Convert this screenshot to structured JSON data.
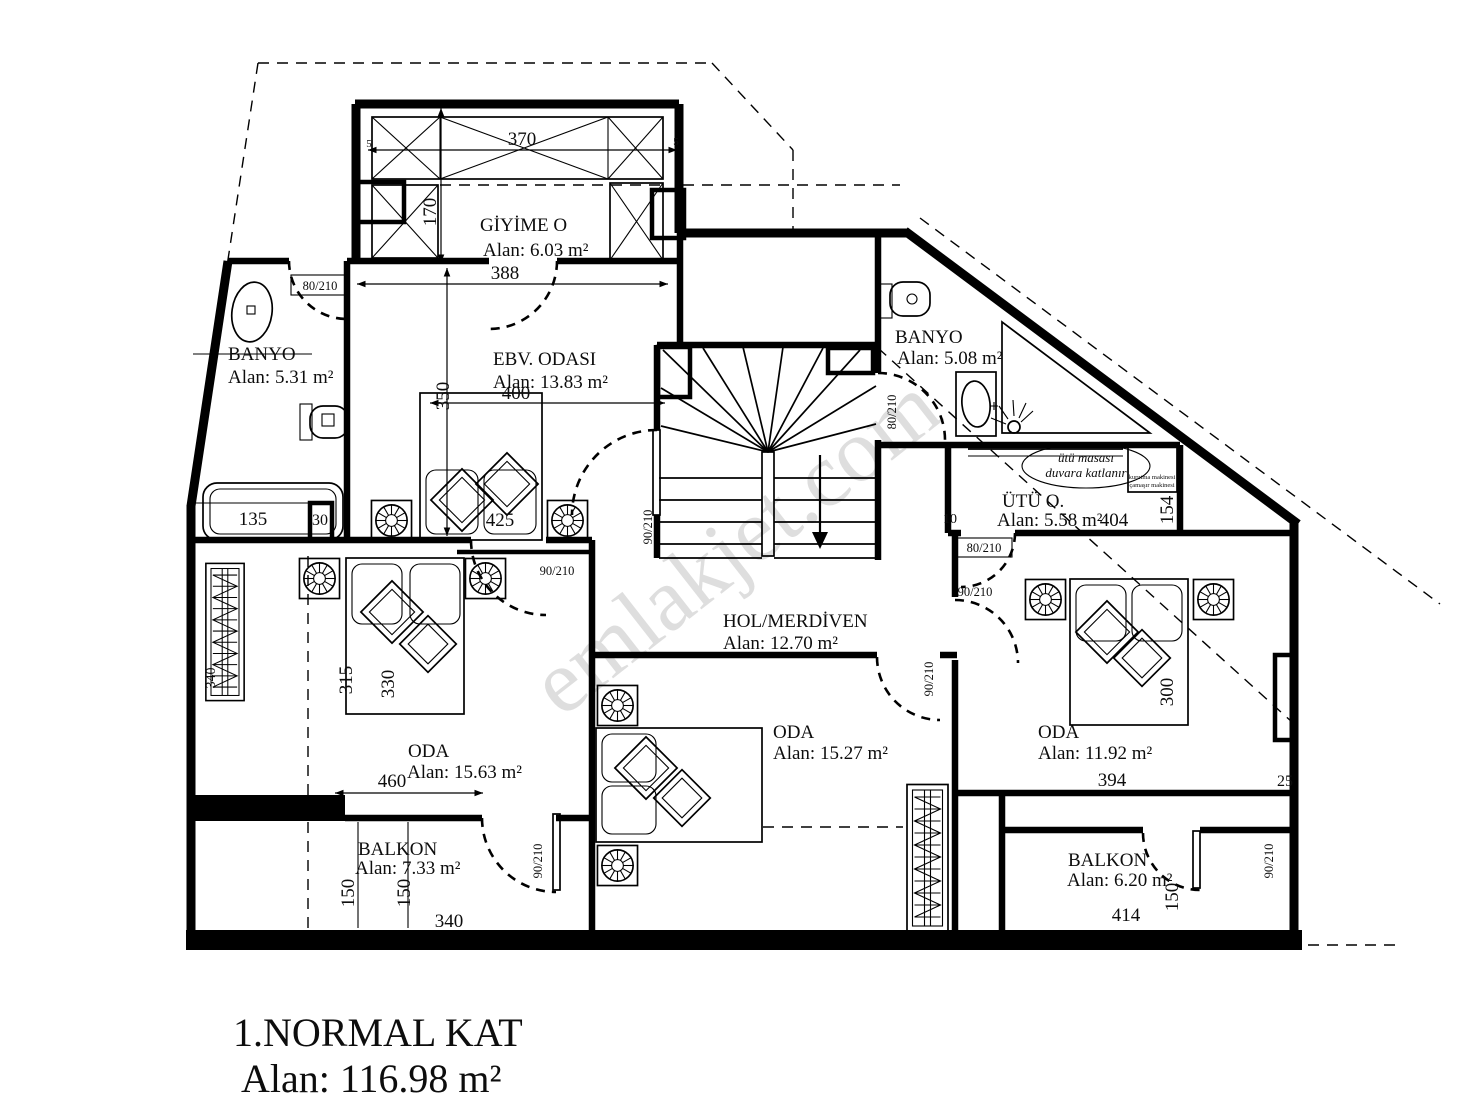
{
  "title": {
    "line1": "1.NORMAL KAT",
    "line2": "Alan: 116.98 m²"
  },
  "watermark": "emlakjet.com",
  "rooms": {
    "giyime": {
      "name": "GİYİME O",
      "area": "Alan: 6.03 m²"
    },
    "banyo_sol": {
      "name": "BANYO",
      "area": "Alan: 5.31 m²"
    },
    "ebv": {
      "name": "EBV. ODASI",
      "area": "Alan: 13.83 m²"
    },
    "banyo_sag": {
      "name": "BANYO",
      "area": "Alan: 5.08 m²"
    },
    "utu": {
      "name": "ÜTÜ O.",
      "area": "Alan: 5.58 m²"
    },
    "hol": {
      "name": "HOL/MERDİVEN",
      "area": "Alan: 12.70 m²"
    },
    "oda_sol": {
      "name": "ODA",
      "area": "Alan: 15.63 m²"
    },
    "oda_orta": {
      "name": "ODA",
      "area": "Alan: 15.27 m²"
    },
    "oda_sag": {
      "name": "ODA",
      "area": "Alan: 11.92 m²"
    },
    "balkon_sol": {
      "name": "BALKON",
      "area": "Alan: 7.33 m²"
    },
    "balkon_sag": {
      "name": "BALKON",
      "area": "Alan: 6.20 m²"
    }
  },
  "notes": {
    "iron1": "ütü masası",
    "iron2": "duvara katlanır",
    "app1": "kurutma makinesi",
    "app2": "çamaşır makinesi"
  },
  "dims": {
    "d370": "370",
    "d170": "170",
    "d5a": "5",
    "d5b": "5",
    "d388": "388",
    "d400": "400",
    "d350": "350",
    "d425": "425",
    "d135": "135",
    "d30": "30",
    "d315": "315",
    "d330": "330",
    "d460": "460",
    "d340_rad": "340",
    "d150a": "150",
    "d150b": "150",
    "d340": "340",
    "d404": "404",
    "d154": "154",
    "d10": "10",
    "d394": "394",
    "d25": "25",
    "d300": "300",
    "d414": "414",
    "d150c": "150"
  },
  "doors": {
    "k80a": "80/210",
    "k80b": "80/210",
    "k80c": "80/210",
    "k90a": "90/210",
    "k90b": "90/210",
    "k90c": "90/210",
    "k90d": "90/210",
    "k90e": "90/210",
    "k90f": "90/210"
  }
}
